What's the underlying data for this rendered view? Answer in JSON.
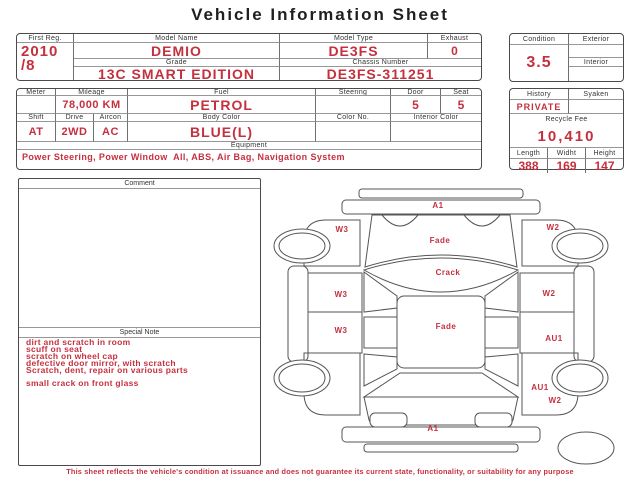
{
  "title": "Vehicle Information Sheet",
  "colors": {
    "accent_red": "#c5303e",
    "border": "#4a4a4a"
  },
  "identity": {
    "first_reg_label": "First Reg.",
    "first_reg_year": "2010",
    "first_reg_month": "/8",
    "model_name_label": "Model Name",
    "model_name": "DEMIO",
    "model_type_label": "Model Type",
    "model_type": "DE3FS",
    "exhaust_label": "Exhaust",
    "exhaust": "0",
    "grade_label": "Grade",
    "grade": "13C SMART EDITION",
    "chassis_label": "Chassis Number",
    "chassis_number": "DE3FS-311251"
  },
  "condition": {
    "condition_label": "Condition",
    "score": "3.5",
    "exterior_label": "Exterior",
    "exterior": "",
    "interior_label": "Interior",
    "interior": ""
  },
  "specs": {
    "meter_label": "Meter",
    "meter": "",
    "mileage_label": "Mileage",
    "mileage": "78,000 KM",
    "fuel_label": "Fuel",
    "fuel": "PETROL",
    "steering_label": "Steering",
    "steering": "",
    "door_label": "Door",
    "door": "5",
    "seat_label": "Seat",
    "seat": "5",
    "shift_label": "Shift",
    "shift": "AT",
    "drive_label": "Drive",
    "drive": "2WD",
    "aircon_label": "Aircon",
    "aircon": "AC",
    "body_color_label": "Body Color",
    "body_color": "BLUE(L)",
    "color_no_label": "Color No.",
    "color_no": "",
    "interior_color_label": "Interior Color",
    "interior_color": "",
    "equipment_label": "Equipment",
    "equipment": "Power Steering, Power Window  All, ABS, Air Bag, Navigation System"
  },
  "history_box": {
    "history_label": "History",
    "history": "PRIVATE",
    "syaken_label": "Syaken",
    "syaken": "",
    "recycle_fee_label": "Recycle Fee",
    "recycle_fee": "10,410",
    "length_label": "Length",
    "length": "388",
    "width_label": "Widht",
    "width": "169",
    "height_label": "Height",
    "height": "147"
  },
  "comment": {
    "label": "Comment",
    "text": ""
  },
  "special_note": {
    "label": "Special Note",
    "lines": [
      "dirt and scratch in room",
      "scuff on seat",
      "scratch on wheel cap",
      "defective door mirror, with scratch",
      "Scratch, dent, repair on various parts",
      "",
      "small crack on front glass"
    ]
  },
  "diagram": {
    "labels": [
      {
        "part": "front-bumper",
        "text": "A1"
      },
      {
        "part": "left-front-fender",
        "text": "W3"
      },
      {
        "part": "right-front-fender",
        "text": "W2"
      },
      {
        "part": "hood",
        "text": "Fade"
      },
      {
        "part": "windshield",
        "text": "Crack"
      },
      {
        "part": "left-front-door",
        "text": "W3"
      },
      {
        "part": "right-front-door",
        "text": "W2"
      },
      {
        "part": "left-rear-door",
        "text": "W3"
      },
      {
        "part": "roof",
        "text": "Fade"
      },
      {
        "part": "right-rear-door",
        "text": "AU1"
      },
      {
        "part": "right-rear-fender",
        "text": "AU1"
      },
      {
        "part": "right-rear-fender-lower",
        "text": "W2"
      },
      {
        "part": "rear-bumper",
        "text": "A1"
      }
    ]
  },
  "disclaimer": "This sheet reflects the vehicle's condition at issuance and does not guarantee its current state, functionality, or suitability for any purpose"
}
